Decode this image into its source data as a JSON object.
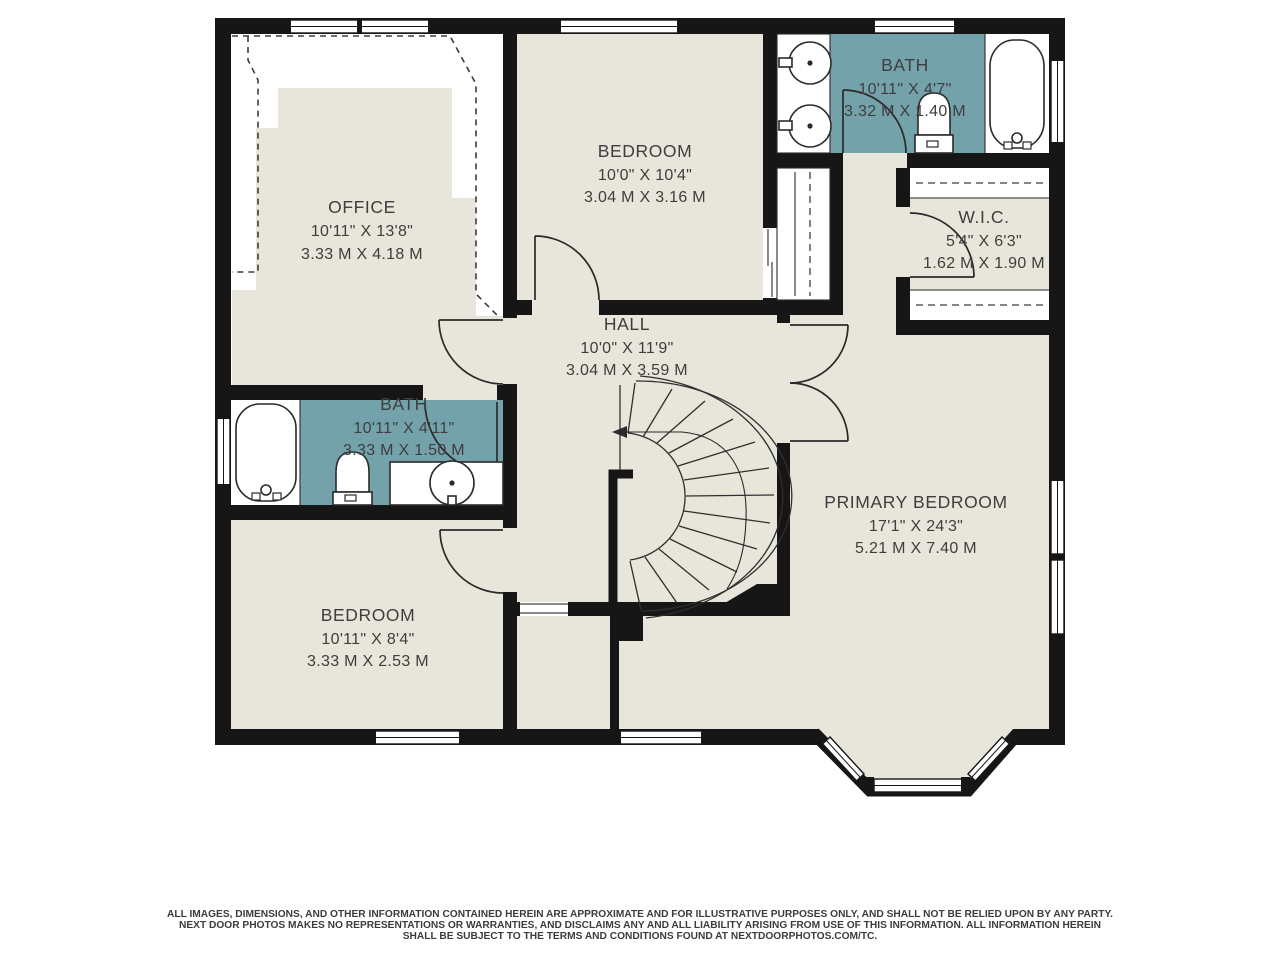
{
  "colors": {
    "background": "#ffffff",
    "wall": "#161616",
    "floor": "#e8e5da",
    "bath_floor": "#74a2ab",
    "label_text": "#3e3e3e"
  },
  "rooms": {
    "office": {
      "name": "OFFICE",
      "imperial": "10'11\" X 13'8\"",
      "metric": "3.33 M X 4.18 M"
    },
    "bedroom_top": {
      "name": "BEDROOM",
      "imperial": "10'0\" X 10'4\"",
      "metric": "3.04 M X 3.16 M"
    },
    "bath_top": {
      "name": "BATH",
      "imperial": "10'11\" X 4'7\"",
      "metric": "3.32 M X 1.40 M"
    },
    "wic": {
      "name": "W.I.C.",
      "imperial": "5'4\" X 6'3\"",
      "metric": "1.62 M X 1.90 M"
    },
    "hall": {
      "name": "HALL",
      "imperial": "10'0\" X 11'9\"",
      "metric": "3.04 M X 3.59 M"
    },
    "bath_left": {
      "name": "BATH",
      "imperial": "10'11\" X 4'11\"",
      "metric": "3.33 M X 1.50 M"
    },
    "bedroom_bottom": {
      "name": "BEDROOM",
      "imperial": "10'11\" X 8'4\"",
      "metric": "3.33 M X 2.53 M"
    },
    "primary_bedroom": {
      "name": "PRIMARY BEDROOM",
      "imperial": "17'1\" X 24'3\"",
      "metric": "5.21 M X 7.40 M"
    }
  },
  "footer": {
    "line1": "ALL IMAGES, DIMENSIONS, AND OTHER INFORMATION CONTAINED HEREIN ARE APPROXIMATE AND FOR ILLUSTRATIVE PURPOSES ONLY, AND SHALL NOT BE RELIED UPON BY ANY PARTY.",
    "line2": "NEXT DOOR PHOTOS MAKES NO REPRESENTATIONS OR WARRANTIES, AND DISCLAIMS ANY AND ALL LIABILITY ARISING FROM USE OF THIS INFORMATION. ALL INFORMATION HEREIN",
    "line3": "SHALL BE SUBJECT TO THE TERMS AND CONDITIONS FOUND AT NEXTDOORPHOTOS.COM/TC."
  }
}
